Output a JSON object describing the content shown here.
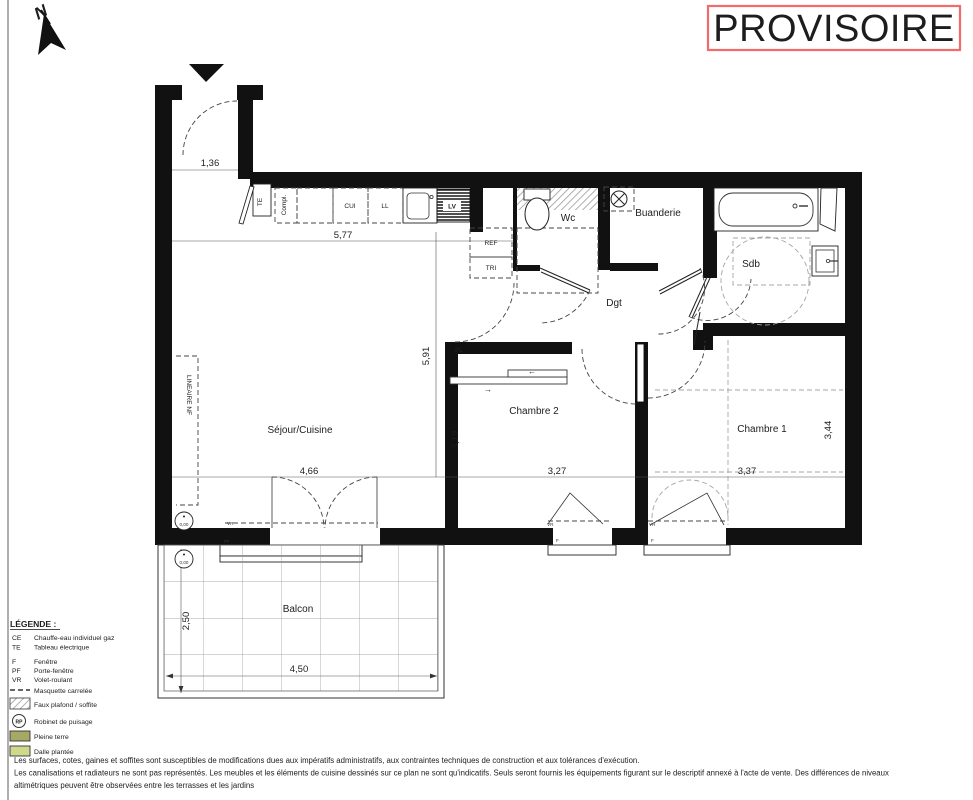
{
  "stamp": {
    "text": "PROVISOIRE",
    "color": "#ee0b0b"
  },
  "compass": {
    "label": "N"
  },
  "rooms": {
    "sejour": "Séjour/Cuisine",
    "chambre2": "Chambre 2",
    "chambre1": "Chambre 1",
    "wc": "Wc",
    "buanderie": "Buanderie",
    "sdb": "Sdb",
    "dgt": "Dgt",
    "balcon": "Balcon"
  },
  "fixtures": {
    "te": "TE",
    "compl": "Compl.",
    "cui": "CUI",
    "ll": "LL",
    "lv": "LV",
    "ref": "REF",
    "tri": "TRI",
    "pl": "PL",
    "lineaire_nf": "LINEAIRE NF",
    "level_zero": "0,00",
    "arrow_left": "←",
    "arrow_right": "→"
  },
  "dimensions": {
    "entry_width": "1,36",
    "kitchen_width": "5,77",
    "sejour_height": "5,91",
    "sejour_width": "4,66",
    "chambre2_height": "3,19",
    "chambre2_width": "3,27",
    "chambre1_width": "3,37",
    "chambre1_height": "3,44",
    "balcon_depth": "2,50",
    "balcon_width": "4,50"
  },
  "window_labels": {
    "vr": "VR",
    "pf": "PF",
    "f": "F"
  },
  "legend": {
    "title": "LÉGENDE :",
    "items": [
      {
        "code": "CE",
        "label": "Chauffe-eau individuel gaz"
      },
      {
        "code": "TE",
        "label": "Tableau électrique"
      },
      {
        "code": "F",
        "label": "Fenêtre"
      },
      {
        "code": "PF",
        "label": "Porte-fenêtre"
      },
      {
        "code": "VR",
        "label": "Volet-roulant"
      },
      {
        "symbol": "dashed-line",
        "label": "Masquette carrelée"
      },
      {
        "symbol": "hatch-box",
        "label": "Faux plafond / soffite"
      },
      {
        "symbol": "rp-circle",
        "code": "RP",
        "label": "Robinet de puisage"
      },
      {
        "symbol": "color-box",
        "label": "Pleine terre"
      },
      {
        "symbol": "color-box",
        "label": "Dalle plantée"
      }
    ],
    "colors": {
      "pleine_terre": "#a6a963",
      "dalle_plantee": "#cfd98c"
    }
  },
  "disclaimer": {
    "lines": [
      "Les surfaces, cotes, gaines et soffites sont susceptibles de modifications dues aux impératifs administratifs, aux contraintes techniques de construction et aux tolérances d'exécution.",
      "Les canalisations et radiateurs ne sont pas représentés. Les meubles et les éléments de cuisine dessinés sur ce plan ne sont qu'indicatifs. Seuls seront fournis les équipements figurant sur le descriptif annexé à l'acte de vente. Des différences de niveaux",
      "altimétriques peuvent être observées entre les terrasses et les jardins"
    ]
  }
}
